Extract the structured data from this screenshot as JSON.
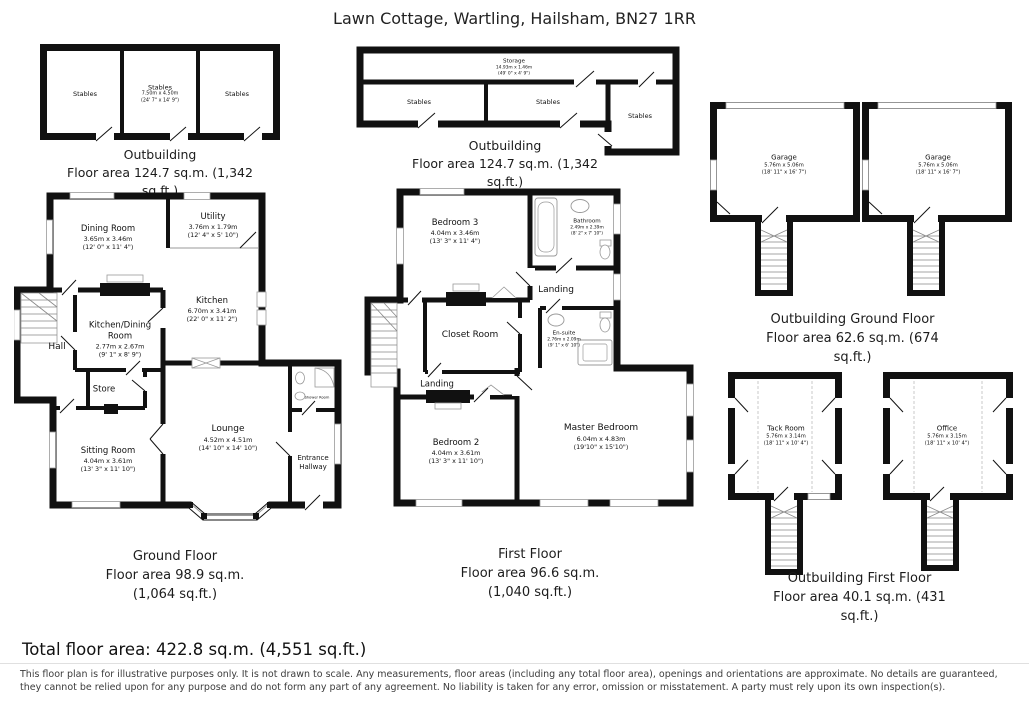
{
  "title": "Lawn Cottage, Wartling, Hailsham, BN27 1RR",
  "plans": {
    "stables_outbuilding": {
      "caption": "Outbuilding",
      "area_l1": "Floor area 124.7 sq.m. (1,342",
      "area_l2": "sq.ft.)",
      "rooms": {
        "stables_left": {
          "name": "Stables"
        },
        "stables_mid": {
          "name": "Stables",
          "dims_m": "7.50m x 4.50m",
          "dims_ft": "(24' 7\" x 14' 9\")"
        },
        "stables_right": {
          "name": "Stables"
        }
      }
    },
    "storage_outbuilding": {
      "caption": "Outbuilding",
      "area_l1": "Floor area 124.7 sq.m. (1,342",
      "area_l2": "sq.ft.)",
      "rooms": {
        "storage": {
          "name": "Storage",
          "dims_m": "14.93m x 1.46m",
          "dims_ft": "(49' 0\" x 4' 9\")"
        },
        "stables_left": {
          "name": "Stables"
        },
        "stables_mid": {
          "name": "Stables"
        },
        "stables_right": {
          "name": "Stables"
        }
      }
    },
    "outbuilding_ground": {
      "caption": "Outbuilding Ground Floor",
      "area_l1": "Floor area 62.6 sq.m. (674",
      "area_l2": "sq.ft.)",
      "rooms": {
        "garage_left": {
          "name": "Garage",
          "dims_m": "5.76m x 5.06m",
          "dims_ft": "(18' 11\" x 16' 7\")"
        },
        "garage_right": {
          "name": "Garage",
          "dims_m": "5.76m x 5.06m",
          "dims_ft": "(18' 11\" x 16' 7\")"
        }
      }
    },
    "ground_floor": {
      "caption": "Ground Floor",
      "area_l1": "Floor area 98.9 sq.m.",
      "area_l2": "(1,064 sq.ft.)",
      "rooms": {
        "dining_room": {
          "name": "Dining Room",
          "dims_m": "3.65m x 3.46m",
          "dims_ft": "(12' 0\" x 11' 4\")"
        },
        "utility": {
          "name": "Utility",
          "dims_m": "3.76m x 1.79m",
          "dims_ft": "(12' 4\" x 5' 10\")"
        },
        "kitchen": {
          "name": "Kitchen",
          "dims_m": "6.70m x 3.41m",
          "dims_ft": "(22' 0\" x 11' 2\")"
        },
        "kitchen_dining": {
          "name": "Kitchen/Dining Room",
          "dims_m": "2.77m x 2.67m",
          "dims_ft": "(9' 1\" x 8' 9\")"
        },
        "hall": {
          "name": "Hall"
        },
        "store": {
          "name": "Store"
        },
        "sitting_room": {
          "name": "Sitting Room",
          "dims_m": "4.04m x 3.61m",
          "dims_ft": "(13' 3\" x 11' 10\")"
        },
        "lounge": {
          "name": "Lounge",
          "dims_m": "4.52m x 4.51m",
          "dims_ft": "(14' 10\" x 14' 10\")"
        },
        "entrance_hallway": {
          "name": "Entrance Hallway"
        },
        "shower_room": {
          "name": "Shower Room"
        }
      }
    },
    "first_floor": {
      "caption": "First Floor",
      "area_l1": "Floor area 96.6 sq.m.",
      "area_l2": "(1,040 sq.ft.)",
      "rooms": {
        "bedroom3": {
          "name": "Bedroom 3",
          "dims_m": "4.04m x 3.46m",
          "dims_ft": "(13' 3\" x 11' 4\")"
        },
        "bathroom": {
          "name": "Bathroom",
          "dims_m": "2.49m x 2.39m",
          "dims_ft": "(8' 2\" x 7' 10\")"
        },
        "landing_upper": {
          "name": "Landing"
        },
        "closet_room": {
          "name": "Closet Room"
        },
        "ensuite": {
          "name": "En-suite",
          "dims_m": "2.76m x 2.09m",
          "dims_ft": "(9' 1\" x 6' 10\")"
        },
        "landing_lower": {
          "name": "Landing"
        },
        "bedroom2": {
          "name": "Bedroom 2",
          "dims_m": "4.04m x 3.61m",
          "dims_ft": "(13' 3\" x 11' 10\")"
        },
        "master_bedroom": {
          "name": "Master Bedroom",
          "dims_m": "6.04m x 4.83m",
          "dims_ft": "(19'10\" x 15'10\")"
        }
      }
    },
    "outbuilding_first": {
      "caption": "Outbuilding First Floor",
      "area_l1": "Floor area 40.1 sq.m. (431",
      "area_l2": "sq.ft.)",
      "rooms": {
        "tack_room": {
          "name": "Tack Room",
          "dims_m": "5.76m x 3.14m",
          "dims_ft": "(18' 11\" x 10' 4\")"
        },
        "office": {
          "name": "Office",
          "dims_m": "5.76m x 3.15m",
          "dims_ft": "(18' 11\" x 10' 4\")"
        }
      }
    }
  },
  "footer": {
    "total": "Total floor area: 422.8 sq.m. (4,551 sq.ft.)",
    "disclaimer": "This floor plan is for illustrative purposes only. It is not drawn to scale. Any measurements, floor areas (including any total floor area), openings and orientations are approximate. No details are guaranteed, they cannot be relied upon for any purpose and do not form any part of any agreement. No liability is taken for any error, omission or misstatement. A party must rely upon its own inspection(s)."
  },
  "colors": {
    "wall": "#111111",
    "text": "#1b1b1b"
  }
}
